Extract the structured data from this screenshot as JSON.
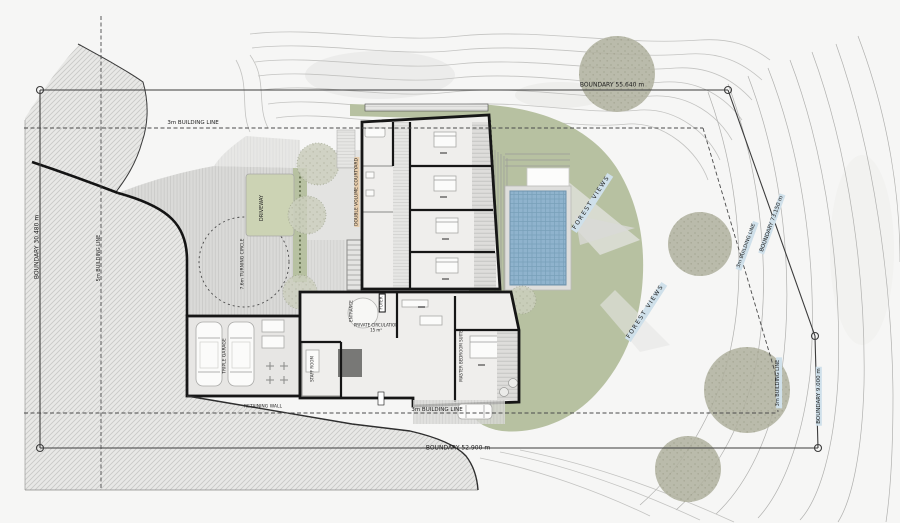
{
  "drawing": {
    "type": "architectural site plan",
    "boundaries": {
      "top": "BOUNDARY 55.640 m",
      "left": "BOUNDARY 30.480 m",
      "bottom": "BOUNDARY 52.900 m",
      "right_upper": "BOUNDARY 73.150 m",
      "right_lower": "BOUNDARY 9.000 m"
    },
    "building_lines": {
      "top": "3m BUILDING LINE",
      "bottom": "3m BUILDING LINE",
      "right": "3m BUILDING LINE",
      "right_lower": "3m BUILDING LINE",
      "left": "5m BUILDING LINE"
    },
    "site_labels": {
      "driveway": "DRIVEWAY",
      "turning_circle": "7.6m TURNING CIRCLE",
      "retaining_wall": "RETAINING WALL",
      "forest_views_upper": "FOREST VIEWS",
      "forest_views_lower": "FOREST VIEWS"
    },
    "room_labels": {
      "garage": "TRIPLE GARAGE",
      "staff_room": "STAFF ROOM",
      "entrance": "ENTRANCE",
      "foyer": "FOYER",
      "private_circulation": "PRIVATE CIRCULATION",
      "private_circulation_area": "15 m²",
      "courtyard": "DOUBLE VOLUME COURTYARD",
      "master_suite": "MASTER BEDROOM SUITE"
    }
  },
  "colors": {
    "paper": "#f6f6f5",
    "lawn": "#b7c1a1",
    "lawn_light": "#ccd3b4",
    "pool_water": "#8fb3cd",
    "pool_edge": "#6f93ad",
    "tree": "#b2b3a1",
    "wall": "#161616",
    "room": "#efeeec",
    "hatch_bg": "#e8e8e6",
    "hatch_line": "#c8c8c6",
    "highlight": "#cfe0ea",
    "boundary": "#3c3c3c",
    "contour": "#c3c3c1"
  }
}
